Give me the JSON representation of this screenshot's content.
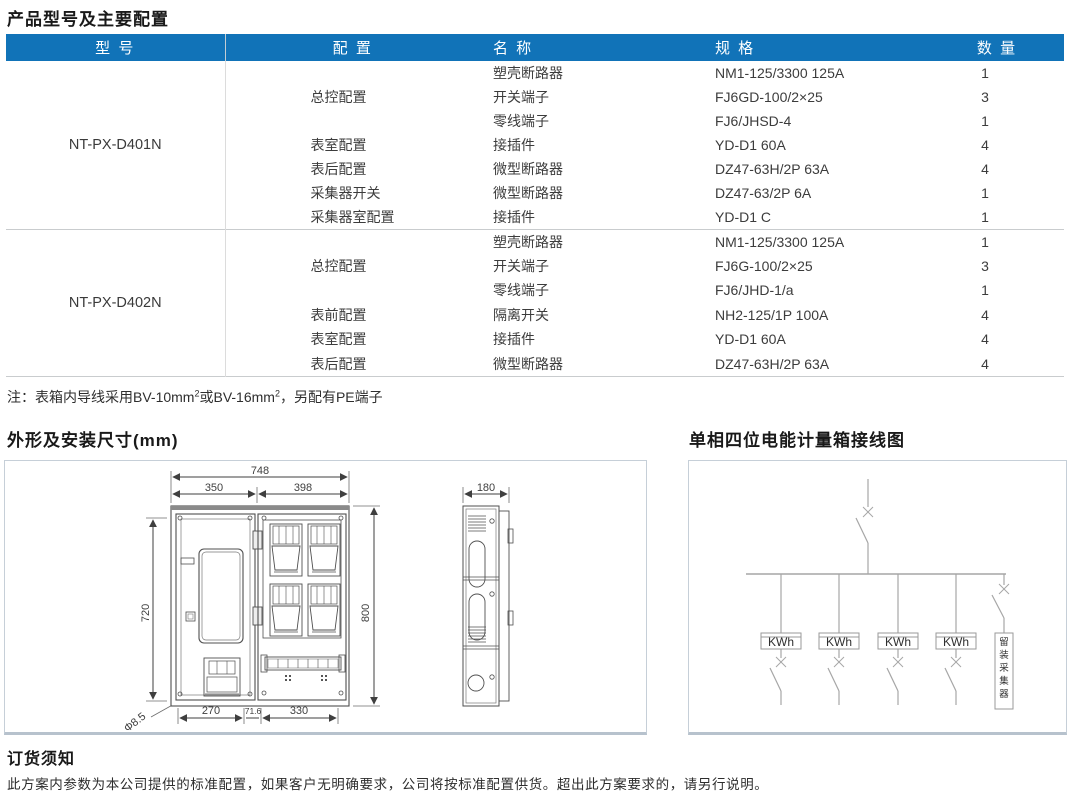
{
  "page_title": "产品型号及主要配置",
  "table": {
    "headers": [
      "型 号",
      "配 置",
      "名 称",
      "规 格",
      "数 量"
    ],
    "groups": [
      {
        "model": "NT-PX-D401N",
        "rows": [
          {
            "config": "",
            "name": "塑壳断路器",
            "spec": "NM1-125/3300 125A",
            "qty": "1"
          },
          {
            "config": "总控配置",
            "name": "开关端子",
            "spec": "FJ6GD-100/2×25",
            "qty": "3"
          },
          {
            "config": "",
            "name": "零线端子",
            "spec": "FJ6/JHSD-4",
            "qty": "1"
          },
          {
            "config": "表室配置",
            "name": "接插件",
            "spec": "YD-D1 60A",
            "qty": "4"
          },
          {
            "config": "表后配置",
            "name": "微型断路器",
            "spec": "DZ47-63H/2P 63A",
            "qty": "4"
          },
          {
            "config": "采集器开关",
            "name": "微型断路器",
            "spec": "DZ47-63/2P 6A",
            "qty": "1"
          },
          {
            "config": "采集器室配置",
            "name": "接插件",
            "spec": "YD-D1 C",
            "qty": "1"
          }
        ]
      },
      {
        "model": "NT-PX-D402N",
        "rows": [
          {
            "config": "",
            "name": "塑壳断路器",
            "spec": "NM1-125/3300 125A",
            "qty": "1"
          },
          {
            "config": "总控配置",
            "name": "开关端子",
            "spec": "FJ6G-100/2×25",
            "qty": "3"
          },
          {
            "config": "",
            "name": "零线端子",
            "spec": "FJ6/JHD-1/a",
            "qty": "1"
          },
          {
            "config": "表前配置",
            "name": "隔离开关",
            "spec": "NH2-125/1P 100A",
            "qty": "4"
          },
          {
            "config": "表室配置",
            "name": "接插件",
            "spec": "YD-D1 60A",
            "qty": "4"
          },
          {
            "config": "表后配置",
            "name": "微型断路器",
            "spec": "DZ47-63H/2P 63A",
            "qty": "4"
          }
        ]
      }
    ]
  },
  "note": {
    "part1": "注：表箱内导线采用BV-10mm",
    "sup1": "2",
    "part2": "或BV-16mm",
    "sup2": "2",
    "part3": "，另配有PE端子"
  },
  "dimensions_section": {
    "title": "外形及安装尺寸(mm)",
    "dims": {
      "total_width": "748",
      "left_width": "350",
      "right_width": "398",
      "depth": "180",
      "inner_height": "720",
      "height": "800",
      "bottom_left": "270",
      "bottom_mid": "71.6",
      "bottom_right": "330",
      "hole": "Φ8.5"
    }
  },
  "wiring_section": {
    "title": "单相四位电能计量箱接线图",
    "meters": [
      "KWh",
      "KWh",
      "KWh",
      "KWh"
    ],
    "collector_label": "留装采集器"
  },
  "ordering": {
    "title": "订货须知",
    "body": "此方案内参数为本公司提供的标准配置，如果客户无明确要求，公司将按标准配置供货。超出此方案要求的，请另行说明。"
  },
  "colors": {
    "header_bg": "#1173b8",
    "header_text": "#ffffff"
  }
}
